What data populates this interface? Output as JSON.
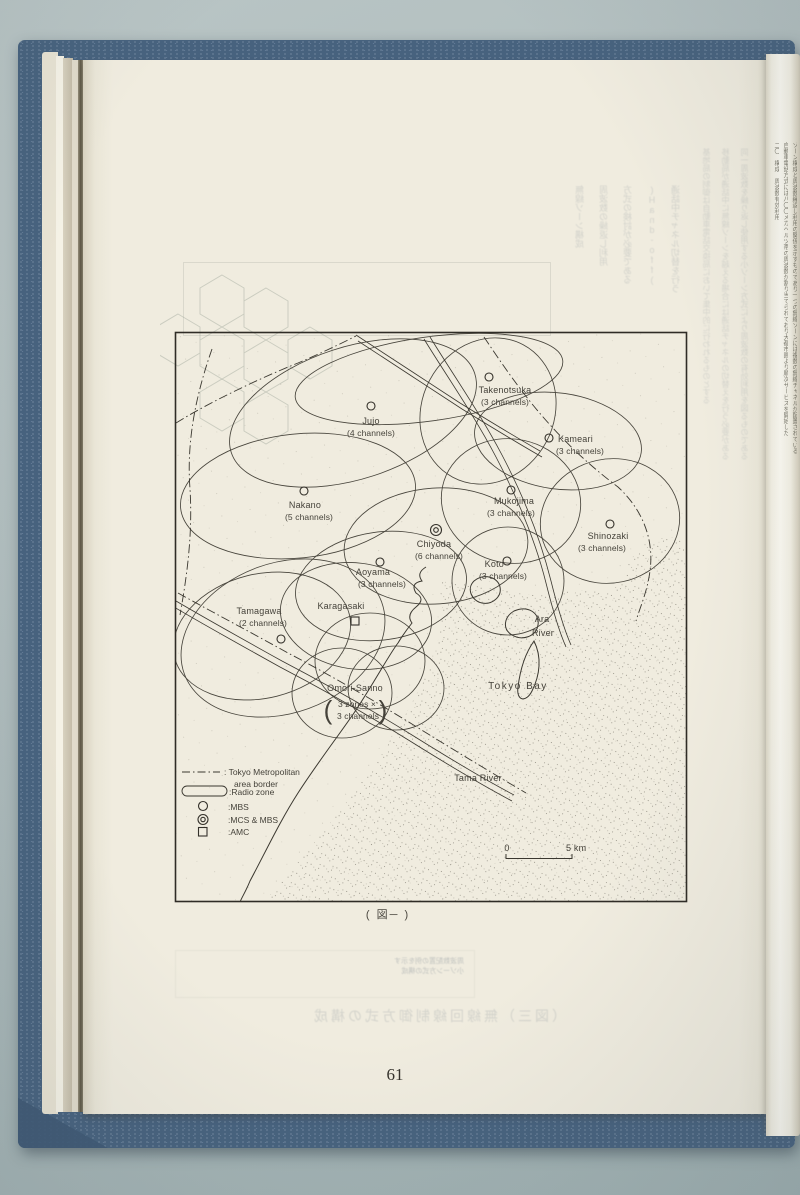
{
  "colors": {
    "cover_blue": "#47627e",
    "paper": "#f0ecdf",
    "background": "#adbabb",
    "ink": "#45423a"
  },
  "page": {
    "number": "61",
    "caption": "( 図─ )"
  },
  "map": {
    "zones": [
      {
        "name": "Jujo",
        "channels": "(4 channels)",
        "marker": "MBS circle"
      },
      {
        "name": "Takenotsuka",
        "channels": "(3 channels)",
        "marker": "MBS circle"
      },
      {
        "name": "Kameari",
        "channels": "(3 channels)",
        "marker": "MBS circle"
      },
      {
        "name": "Nakano",
        "channels": "(5 channels)",
        "marker": "MBS circle"
      },
      {
        "name": "Mukojima",
        "channels": "(3 channels)",
        "marker": "MBS circle"
      },
      {
        "name": "Chiyoda",
        "channels": "(6 channels)",
        "marker": "MCS & MBS double circle"
      },
      {
        "name": "Shinozaki",
        "channels": "(3 channels)",
        "marker": "MBS circle"
      },
      {
        "name": "Koto",
        "channels": "(3 channels)",
        "marker": "MBS circle"
      },
      {
        "name": "Aoyama",
        "channels": "(3 channels)",
        "marker": "MBS circle"
      },
      {
        "name": "Tamagawa",
        "channels": "(2 channels)",
        "marker": "MBS circle"
      },
      {
        "name": "Karagasaki",
        "channels": "",
        "marker": "AMC square"
      },
      {
        "name": "Omori-Sanno",
        "line1": "3 zones ×",
        "line2": "3 channels",
        "paren_open": "(",
        "paren_close": ")"
      }
    ],
    "features": {
      "ara1": "Ara",
      "ara2": "River",
      "tokyo_bay": "Tokyo Bay",
      "tama_river": "Tama River"
    },
    "legend": {
      "border1": ": Tokyo Metropolitan",
      "border2": "area border",
      "radio_zone": ":Radio  zone",
      "mbs": ":MBS",
      "mcs_mbs": ":MCS & MBS",
      "amc": ":AMC"
    },
    "scale": {
      "start": "0",
      "end": "5 km"
    }
  },
  "ghost": {
    "top_cols": [
      "通話中チャネル切替を行う",
      "(Hand-off)",
      "方式の検討が必要である",
      "周波数の繰返し利用",
      "無線ゾーン構成"
    ],
    "right_cols": [
      "同一周波数を繰り返し使用する小ゾーン方式により周波数の有効利用を図るものである",
      "移動局が通話中に無線ゾーンを越える場合には通話チャネルの切替えを行う必要がある",
      "基地局の制御は自動車電話交換局において集中的に行われるものとする"
    ],
    "box_line1": "周波数配置の例を示す",
    "box_line2": "小ゾーン方式の構成",
    "bottom_caption": "（図三）無線回線制御方式の構成"
  },
  "next_page": {
    "col1": "ゾーン構成と周波数繰返し利用の関係を示すものであり一つの無線ゾーンには複数の無線チャネルが配置されている",
    "col2": "自動車電話方式には八〇〇メガヘルツ帯の周波数が割り当てられており大都市圏より順次サービスを開始した",
    "col3": "二〇　構成　周波数有効利用"
  }
}
